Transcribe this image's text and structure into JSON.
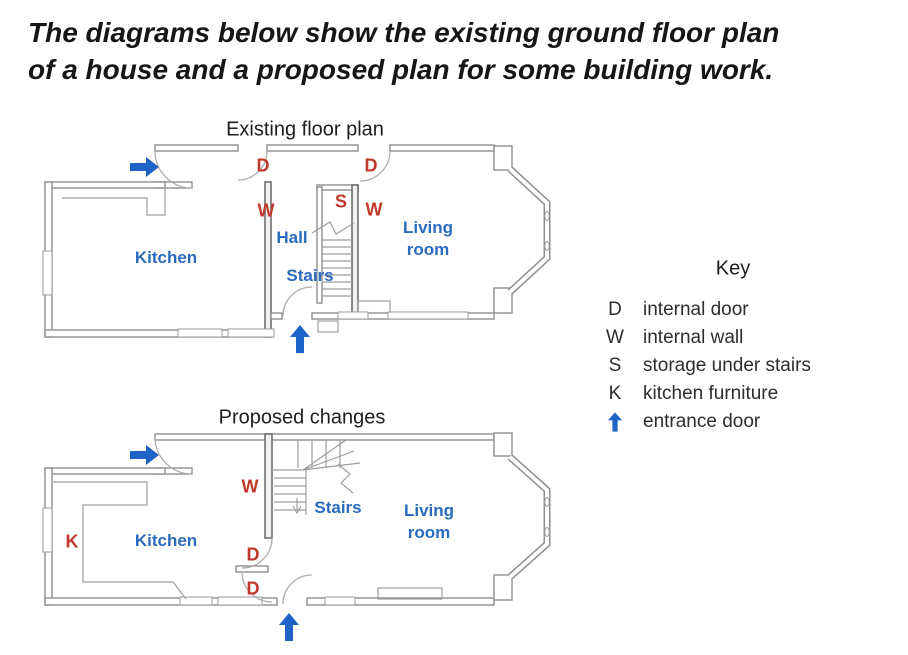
{
  "page": {
    "title_line1": "The diagrams below show the existing ground floor plan",
    "title_line2": "of a house and a proposed plan for some building work."
  },
  "existing_plan": {
    "title": "Existing floor plan",
    "rooms": {
      "kitchen": "Kitchen",
      "hall": "Hall",
      "stairs": "Stairs",
      "living_room": "Living room"
    },
    "markers": {
      "door_hall": "D",
      "door_living": "D",
      "wall_hall": "W",
      "wall_living": "W",
      "storage": "S"
    }
  },
  "proposed_plan": {
    "title": "Proposed changes",
    "rooms": {
      "kitchen": "Kitchen",
      "stairs": "Stairs",
      "living_room": "Living room"
    },
    "markers": {
      "wall": "W",
      "door_upper": "D",
      "door_lower": "D",
      "kitchen_furniture": "K"
    }
  },
  "key": {
    "title": "Key",
    "items": [
      {
        "symbol": "D",
        "label": "internal door"
      },
      {
        "symbol": "W",
        "label": "internal wall"
      },
      {
        "symbol": "S",
        "label": "storage under stairs"
      },
      {
        "symbol": "K",
        "label": "kitchen furniture"
      },
      {
        "symbol_icon": "arrow-up-icon",
        "label": "entrance door"
      }
    ]
  },
  "colors": {
    "label_blue": "#2b6bbd",
    "marker_red": "#c0392b",
    "arrow_blue": "#1e63c8",
    "wall_gray": "#8f8f8f",
    "key_text": "#2d2d2d"
  }
}
